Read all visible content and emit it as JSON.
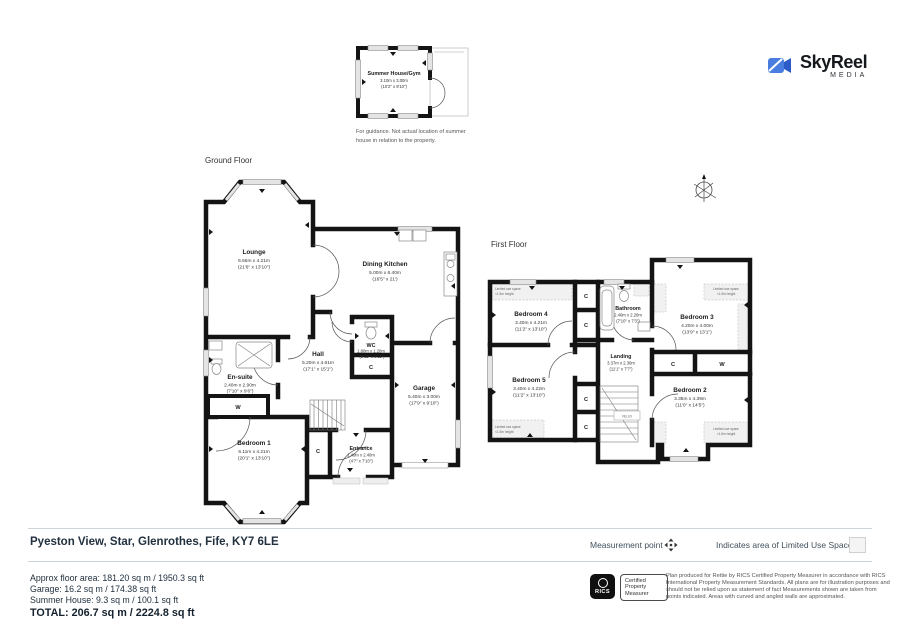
{
  "brand": {
    "name": "SkyReel",
    "media": "MEDIA"
  },
  "summer_house": {
    "name": "Summer House/Gym",
    "m": "3.10m x 3.00m",
    "ft": "(10'2\" x 9'10\")",
    "note1": "For guidance. Not actual location of summer",
    "note2": "house in relation to the property."
  },
  "floors": {
    "ground": {
      "label": "Ground Floor",
      "lounge": {
        "name": "Lounge",
        "m": "6.55m x 4.21m",
        "ft": "(21'6\" x 13'10\")"
      },
      "dining_kitchen": {
        "name": "Dining Kitchen",
        "m": "5.00m x 6.40m",
        "ft": "(16'5\" x 21')"
      },
      "wc": {
        "name": "WC",
        "m": "1.80m x 1.20m",
        "ft": "(5'11\" x 3'11\")"
      },
      "hall": {
        "name": "Hall",
        "m": "5.20m x 4.61m",
        "ft": "(17'1\" x 15'1\")"
      },
      "ensuite": {
        "name": "En-suite",
        "m": "2.40m x 2.90m",
        "ft": "(7'10\" x 9'6\")"
      },
      "bedroom1": {
        "name": "Bedroom 1",
        "m": "6.11m x 4.21m",
        "ft": "(20'1\" x 13'10\")"
      },
      "entrance": {
        "name": "Entrance",
        "m": "1.40m x 2.40m",
        "ft": "(4'7\" x 7'10\")"
      },
      "garage": {
        "name": "Garage",
        "m": "5.40m x 3.00m",
        "ft": "(17'9\" x 9'10\")"
      }
    },
    "first": {
      "label": "First Floor",
      "bedroom4": {
        "name": "Bedroom 4",
        "m": "3.40m x 4.21m",
        "ft": "(11'2\" x 13'10\")"
      },
      "bathroom": {
        "name": "Bathroom",
        "m": "2.40m x 2.20m",
        "ft": "(7'10\" x 7'3\")"
      },
      "bedroom3": {
        "name": "Bedroom 3",
        "m": "4.20m x 4.00m",
        "ft": "(13'9\" x 13'1\")"
      },
      "landing": {
        "name": "Landing",
        "m": "3.37m x 2.30m",
        "ft": "(11'1\" x 7'7\")"
      },
      "bedroom5": {
        "name": "Bedroom 5",
        "m": "3.40m x 4.22m",
        "ft": "(11'2\" x 13'10\")"
      },
      "bedroom2": {
        "name": "Bedroom 2",
        "m": "3.35m x 4.39m",
        "ft": "(11'0\" x 14'5\")"
      }
    }
  },
  "labels": {
    "cupboard": "C",
    "wardrobe": "W",
    "velux": "VELUX",
    "limited1": "Limited use space",
    "limited2": "<1.5m height"
  },
  "footer": {
    "address": "Pyeston View, Star, Glenrothes, Fife, KY7 6LE",
    "measurement_point": "Measurement point",
    "limited_use_legend": "Indicates area of  Limited Use Space",
    "area_line1": "Approx floor area: 181.20 sq m / 1950.3 sq ft",
    "area_line2": "Garage: 16.2 sq m / 174.38 sq ft",
    "area_line3": "Summer House: 9.3 sq m / 100.1 sq ft",
    "total": "TOTAL: 206.7 sq m / 2224.8 sq ft",
    "rics_name": "RICS",
    "rics_badge": "Certified Property Measurer",
    "disclaimer": "Plan produced for Rettie by RICS Certified Property Measurer in accordance with RICS International Property Measurement Standards. All plans are for illustration purposes and should not be relied upon as statement of fact Measurements shown are taken from points indicated. Areas with curved and angled walls are approximated."
  }
}
